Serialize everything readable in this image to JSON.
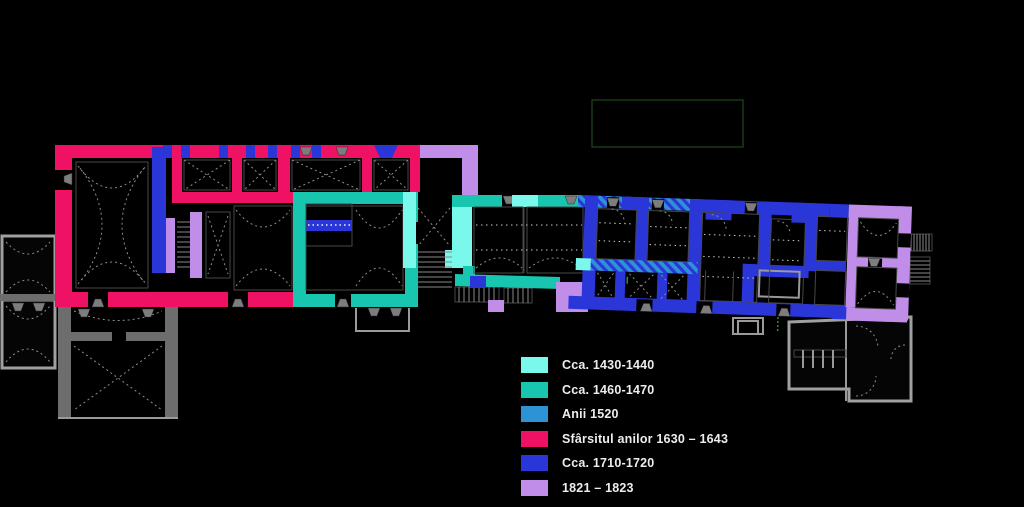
{
  "canvas": {
    "width": 1024,
    "height": 507,
    "background": "#000000"
  },
  "legend": {
    "items": [
      {
        "id": "cca-1430-1440",
        "label": "Cca. 1430-1440",
        "color": "#7BF8EC"
      },
      {
        "id": "cca-1460-1470",
        "label": "Cca. 1460-1470",
        "color": "#18C6AF"
      },
      {
        "id": "anii-1520",
        "label": "Anii 1520",
        "color": "#2E93D5"
      },
      {
        "id": "sfarsitul-1630-1643",
        "label": "Sfârsitul anilor 1630 – 1643",
        "color": "#EF1164"
      },
      {
        "id": "cca-1710-1720",
        "label": "Cca. 1710-1720",
        "color": "#2B36D9"
      },
      {
        "id": "1821-1823",
        "label": "1821 – 1823",
        "color": "#C08EE9"
      }
    ]
  },
  "plan": {
    "structure_gray": "#9a9a9a",
    "annotation_green": "#1E4A1E"
  }
}
